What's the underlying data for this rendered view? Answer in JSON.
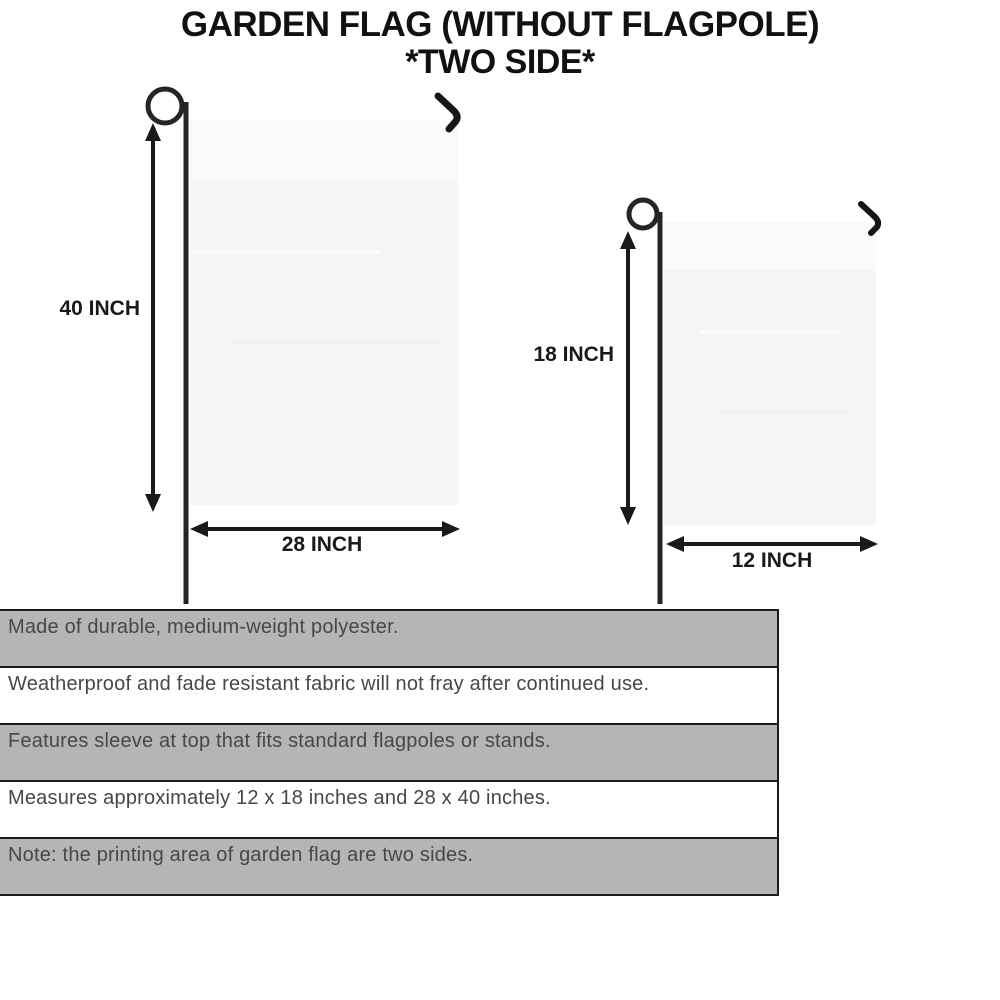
{
  "title": {
    "line1": "GARDEN FLAG (WITHOUT FLAGPOLE)",
    "line2": "*TWO SIDE*"
  },
  "diagram": {
    "large_flag": {
      "name": "large garden flag 28 x 40 inches",
      "height_label": "40 INCH",
      "width_label": "28 INCH"
    },
    "small_flag": {
      "name": "small garden flag 12 x 18 inches",
      "height_label": "18 INCH",
      "width_label": "12 INCH"
    }
  },
  "features": {
    "rows": [
      {
        "text": "Made of durable, medium-weight polyester.",
        "shaded": true
      },
      {
        "text": "Weatherproof and fade resistant fabric will not fray after continued use.",
        "shaded": false
      },
      {
        "text": "Features sleeve at top that fits standard flagpoles or stands.",
        "shaded": true
      },
      {
        "text": "Measures approximately 12 x 18 inches and 28 x 40 inches.",
        "shaded": false
      },
      {
        "text": "Note: the printing area of garden flag are two sides.",
        "shaded": true
      }
    ]
  },
  "colors": {
    "row_shaded_bg": "#b5b5b5",
    "row_plain_bg": "#ffffff",
    "row_border": "#1c1c1c",
    "row_text": "#474747",
    "flag_fill": "#f5f5f6",
    "flag_sleeve_fill": "#fafafa",
    "pole_color": "#252525",
    "arrow_color": "#1a1a1a",
    "title_color": "#111111"
  }
}
